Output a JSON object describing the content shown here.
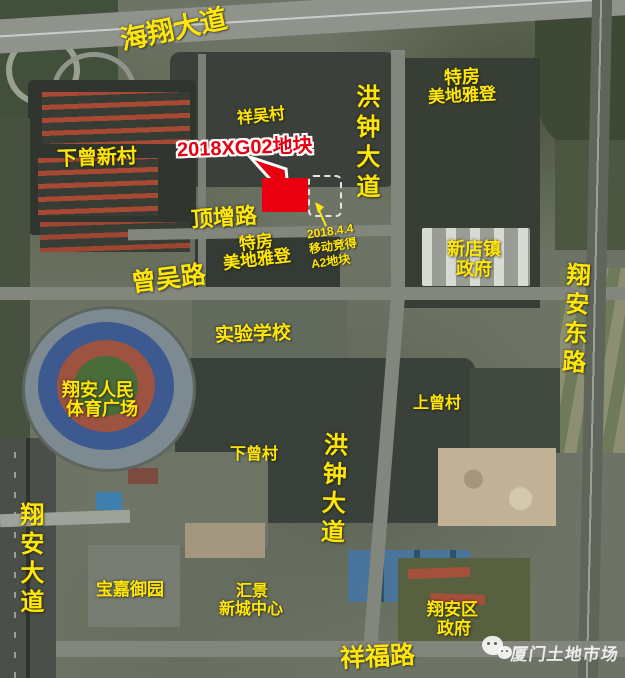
{
  "colors": {
    "label_yellow": "#ffe60a",
    "label_red": "#e60012",
    "plot_red": "#e8000f",
    "dashed_outline": "#e4e4e0"
  },
  "labels": {
    "haixiang_avenue": "海翔大道",
    "xiangwu_village": "祥吴村",
    "tefang_top_l1": "特房",
    "tefang_top_l2": "美地雅登",
    "hongzhong_avenue_top": "洪钟大道",
    "dingzeng_road": "顶增路",
    "tefang_center_l1": "特房",
    "tefang_center_l2": "美地雅登",
    "zengwu_road": "曾吴路",
    "xindian_gov_l1": "新店镇",
    "xindian_gov_l2": "政府",
    "xiangan_east_road": "翔安东路",
    "shiyan_school": "实验学校",
    "stadium_l1": "翔安人民",
    "stadium_l2": "体育广场",
    "shangzeng_village": "上曾村",
    "hongzhong_avenue_bottom": "洪钟大道",
    "xiazeng_village": "下曾村",
    "xiangan_avenue": "翔安大道",
    "baojia_estate": "宝嘉御园",
    "huijing_l1": "汇景",
    "huijing_l2": "新城中心",
    "xiangfu_road": "祥福路",
    "xiangan_district_l1": "翔安区",
    "xiangan_district_l2": "政府",
    "xiazeng_new_village": "下曾新村"
  },
  "plot": {
    "label": "2018XG02地块"
  },
  "annotation": {
    "l1": "2018.4.4",
    "l2": "移动竞得",
    "l3": "A2地块"
  },
  "watermark": {
    "text": "厦门土地市场",
    "icon": "wechat-icon"
  }
}
